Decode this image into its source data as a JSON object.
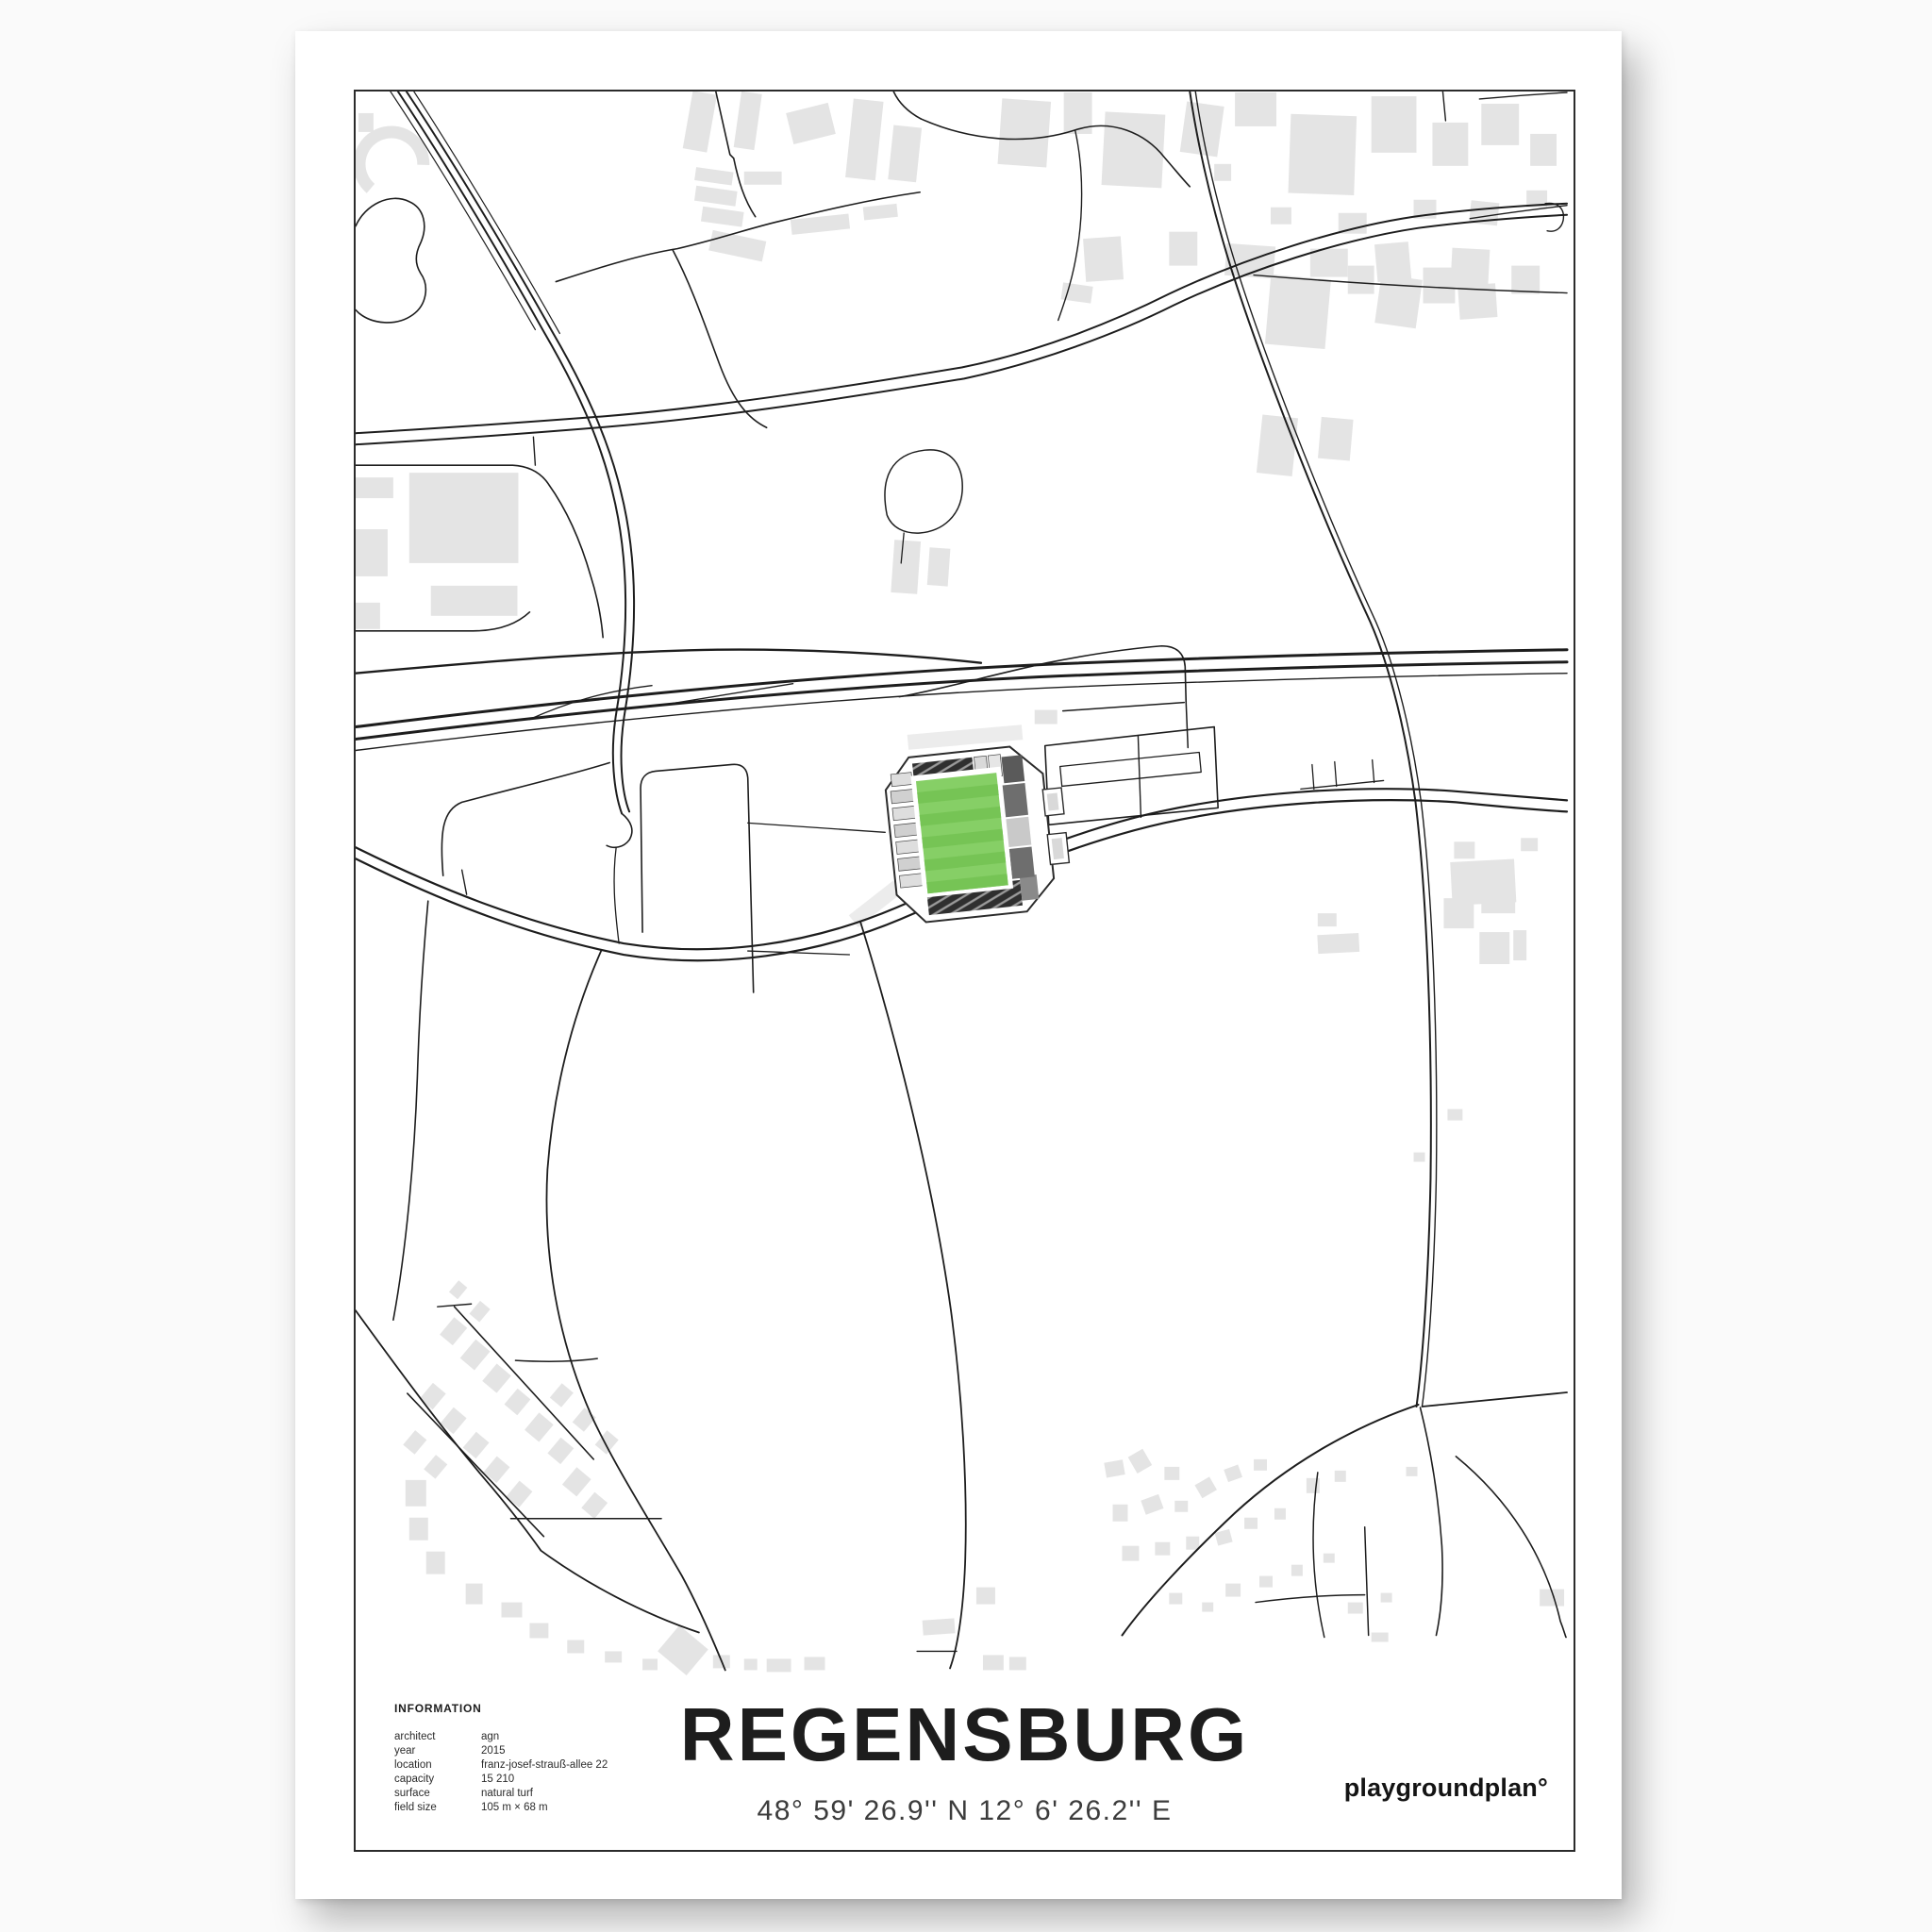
{
  "poster": {
    "title": "REGENSBURG",
    "coordinates": "48° 59' 26.9'' N  12° 6' 26.2'' E",
    "brand": "playgroundplan°",
    "info": {
      "heading": "INFORMATION",
      "rows": [
        {
          "label": "architect",
          "value": "agn"
        },
        {
          "label": "year",
          "value": "2015"
        },
        {
          "label": "location",
          "value": "franz-josef-strauß-allee 22"
        },
        {
          "label": "capacity",
          "value": "15 210"
        },
        {
          "label": "surface",
          "value": "natural turf"
        },
        {
          "label": "field size",
          "value": "105 m × 68 m"
        }
      ]
    },
    "colors": {
      "pitch_green": "#86cf66",
      "pitch_stripe": "#76c455",
      "stand_dark": "#2f2f2f",
      "stand_light": "#d9d9d9",
      "stand_mid": "#8a8a8a",
      "building_gray": "#e4e4e4",
      "road_black": "#1d1d1d",
      "paper_white": "#ffffff"
    }
  }
}
